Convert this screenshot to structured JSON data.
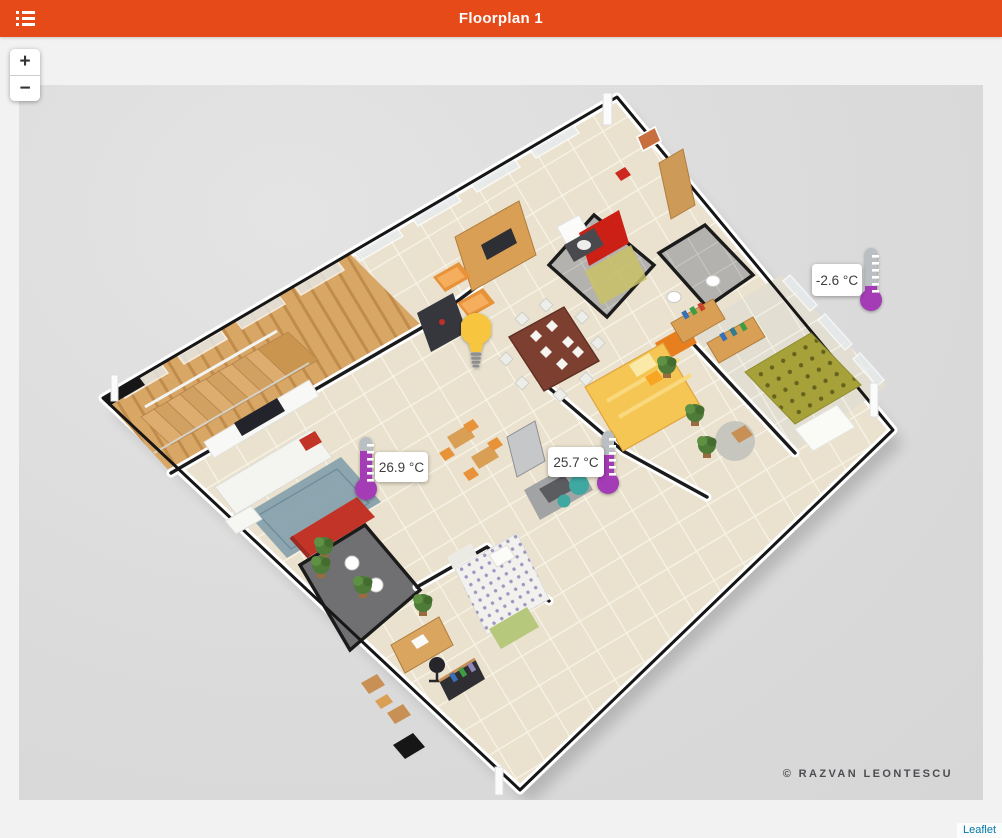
{
  "app_bar": {
    "title": "Floorplan 1",
    "background_color": "#E64A19",
    "menu_icon": "list-menu-icon"
  },
  "map": {
    "zoom_in_label": "+",
    "zoom_out_label": "−",
    "attribution_label": "Leaflet",
    "attribution_color": "#0078A8"
  },
  "floorplan": {
    "watermark": "© Razvan Leontescu",
    "image_background": "#DBDBDB",
    "description": "isometric 3D apartment floorplan render"
  },
  "markers": {
    "light": {
      "kind": "light-bulb",
      "color": "#F7C63E",
      "base_color": "#8D9093",
      "x": 477,
      "y": 339
    },
    "temperature_sensors": [
      {
        "id": "sensor-right",
        "display": "-2.6 °C",
        "value": -2.6,
        "unit": "°C",
        "label_side": "left",
        "fill_percent": 15,
        "x": 871,
        "y": 279
      },
      {
        "id": "sensor-left",
        "display": "26.9 °C",
        "value": 26.9,
        "unit": "°C",
        "label_side": "right",
        "fill_percent": 70,
        "x": 366,
        "y": 467
      },
      {
        "id": "sensor-middle",
        "display": "25.7 °C",
        "value": 25.7,
        "unit": "°C",
        "label_side": "left",
        "fill_percent": 50,
        "x": 608,
        "y": 461
      }
    ],
    "thermometer_colors": {
      "fill": "#A43CB5",
      "empty": "#B9BFC2",
      "ticks": "#FFFFFF"
    }
  }
}
